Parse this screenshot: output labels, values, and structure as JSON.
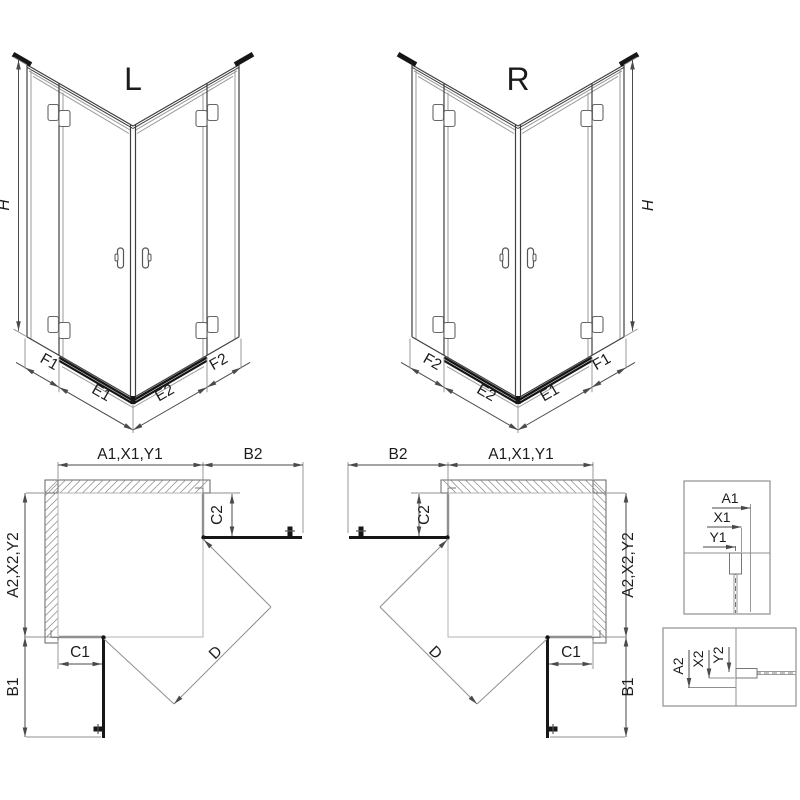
{
  "colors": {
    "background": "#ffffff",
    "line": "#3f3f3f",
    "light_line": "#9a9a9a",
    "dark": "#161616",
    "hatch": "#8f8f8f",
    "dim": "#4a4a4a",
    "text": "#1c1c1c"
  },
  "iso_left": {
    "title": "L",
    "height": "H",
    "b1": "F1",
    "b2": "E1",
    "b3": "E2",
    "b4": "F2"
  },
  "iso_right": {
    "title": "R",
    "height": "H",
    "b1": "F2",
    "b2": "E2",
    "b3": "E1",
    "b4": "F1"
  },
  "plan_left": {
    "top_width": "A1,X1,Y1",
    "top_return": "B2",
    "side_height": "A2,X2,Y2",
    "side_return": "B1",
    "fixed_top": "C2",
    "fixed_bottom": "C1",
    "diagonal": "D"
  },
  "plan_right": {
    "top_width": "A1,X1,Y1",
    "top_return": "B2",
    "side_height": "A2,X2,Y2",
    "side_return": "B1",
    "fixed_top": "C2",
    "fixed_bottom": "C1",
    "diagonal": "D"
  },
  "detail_top": {
    "d1": "A1",
    "d2": "X1",
    "d3": "Y1"
  },
  "detail_bottom": {
    "d1": "A2",
    "d2": "X2",
    "d3": "Y2"
  }
}
